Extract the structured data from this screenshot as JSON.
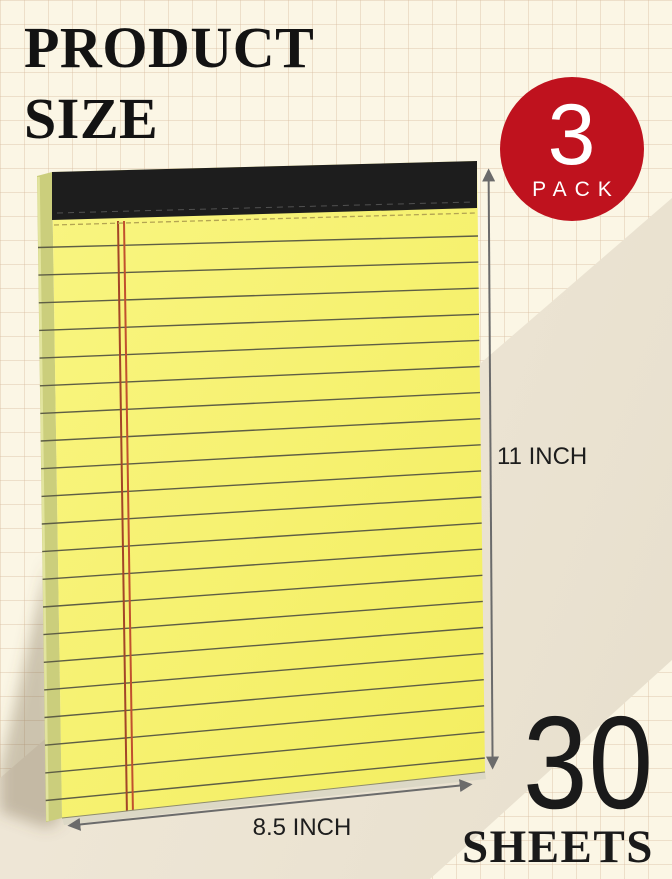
{
  "header": {
    "title_line1": "PRODUCT",
    "title_line2": "SIZE"
  },
  "badge": {
    "count": "3",
    "label": "PACK"
  },
  "dimensions": {
    "height_label": "11 INCH",
    "width_label": "8.5 INCH"
  },
  "sheets": {
    "count": "30",
    "label": "SHEETS"
  },
  "icons": {
    "height_arrow": "vertical-double-arrow-icon",
    "width_arrow": "horizontal-double-arrow-icon"
  },
  "colors": {
    "accent_red": "#bf121e",
    "paper_yellow": "#f7f274",
    "paper_edge_olive": "#cbce7c",
    "binding_black": "#1d1d1d",
    "margin_line_red": "#b14a2c",
    "arrow_gray": "#6b6b6b",
    "background_cream": "#fbf6e5"
  }
}
